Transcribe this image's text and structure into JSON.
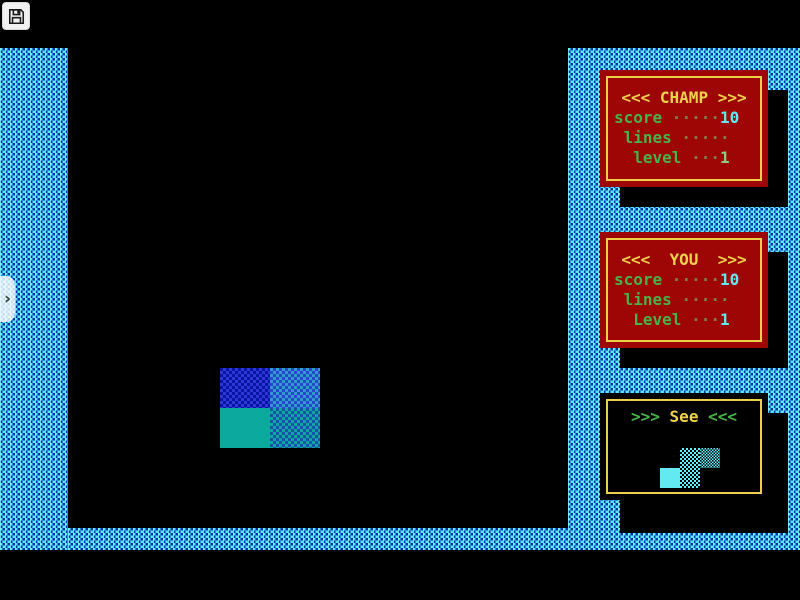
{
  "app": {
    "name": "Tetris (DOS)"
  },
  "overlay": {
    "save_button": {
      "icon": "floppy-disk"
    },
    "drawer_handle": {
      "icon": "chevron-right",
      "glyph": "›"
    }
  },
  "panels": {
    "champ": {
      "title": "<<< CHAMP >>>",
      "rows": [
        {
          "label": "score",
          "dots": " ·····",
          "value": "10"
        },
        {
          "label": " lines",
          "dots": " ·····",
          "value": ""
        },
        {
          "label": "  level",
          "dots": " ···",
          "value": "1"
        }
      ]
    },
    "you": {
      "title": "<<<  YOU  >>>",
      "rows": [
        {
          "label": "score",
          "dots": " ·····",
          "value": "10"
        },
        {
          "label": " lines",
          "dots": " ·····",
          "value": ""
        },
        {
          "label": "  Level",
          "dots": " ···",
          "value": "1"
        }
      ]
    },
    "see": {
      "prefix": ">>> ",
      "word": "See",
      "suffix": " <<<"
    }
  },
  "game": {
    "field_piece": {
      "type": "square-piece",
      "cells": [
        {
          "x": 152,
          "y": 320,
          "w": 50,
          "h": 40,
          "style": "c-blue-a",
          "name": "piece-cell-blue-dither"
        },
        {
          "x": 202,
          "y": 320,
          "w": 50,
          "h": 40,
          "style": "c-blue-b",
          "name": "piece-cell-blue-light-dither"
        },
        {
          "x": 152,
          "y": 360,
          "w": 50,
          "h": 40,
          "style": "c-teal-solid",
          "name": "piece-cell-teal-solid"
        },
        {
          "x": 202,
          "y": 360,
          "w": 50,
          "h": 40,
          "style": "c-teal-d",
          "name": "piece-cell-teal-dither"
        }
      ]
    },
    "next_piece": {
      "type": "s-piece",
      "cells": [
        {
          "x": 80,
          "y": 55,
          "w": 20,
          "h": 20,
          "style": "c-prev-d",
          "name": "preview-cell-dither"
        },
        {
          "x": 100,
          "y": 55,
          "w": 20,
          "h": 20,
          "style": "c-prev-d2",
          "name": "preview-cell-dense-dither"
        },
        {
          "x": 60,
          "y": 75,
          "w": 20,
          "h": 20,
          "style": "c-prev-solid",
          "name": "preview-cell-solid"
        },
        {
          "x": 80,
          "y": 75,
          "w": 20,
          "h": 20,
          "style": "c-prev-d",
          "name": "preview-cell-dither"
        }
      ]
    }
  },
  "colors": {
    "border_cyan": "#55ecfa",
    "border_dot_navy": "#001ca8",
    "panel_red": "#9e0505",
    "panel_yellow": "#edcf4a",
    "text_green": "#46b446",
    "value_cyan": "#63e8f0",
    "piece_blue": "#2a39d6",
    "piece_teal": "#0ba99e",
    "preview_cyan": "#62e9f2",
    "shadow_black": "#000000"
  }
}
